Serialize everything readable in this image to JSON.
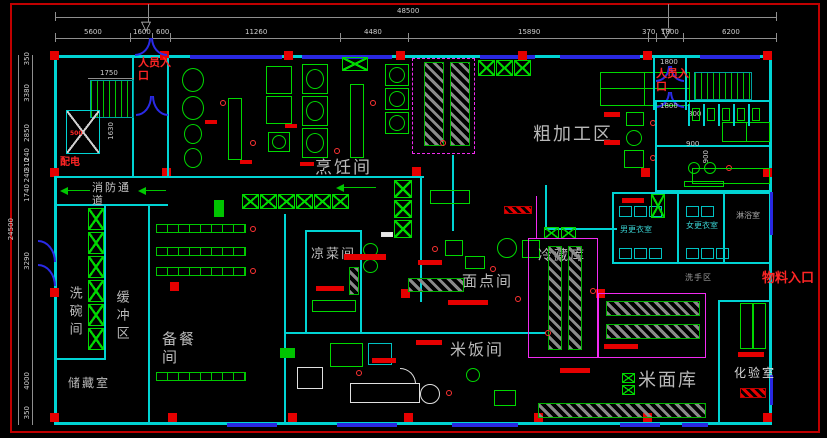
{
  "drawing": {
    "rooms": {
      "cooking": "烹饪间",
      "rough_processing": "粗加工区",
      "cold_dish": "凉菜间",
      "pastry": "面点间",
      "rice": "米饭间",
      "rice_flour_store": "米面库",
      "cold_storage": "冷藏库",
      "lab": "化验室",
      "dishwashing": "洗碗间",
      "buffer": "缓冲区",
      "food_prep": "备餐间",
      "storage": "储藏室",
      "fire_corridor": "消防通道",
      "men_changing": "男更衣室",
      "women_changing": "女更衣室",
      "shower": "淋浴室",
      "wash_area": "洗手区"
    },
    "entrances": {
      "personnel_left": "人员入口",
      "personnel_right": "人员入口",
      "material": "物料入口",
      "power": "配电"
    },
    "dims": {
      "top_total": "48500",
      "top": [
        "5600",
        "1600",
        "600",
        "11260",
        "4480",
        "15890",
        "370",
        "1800",
        "6200"
      ],
      "left_total": "24500",
      "left": [
        "350",
        "3380",
        "2850",
        "240",
        "310",
        "240",
        "1740",
        "3290",
        "4000",
        "350"
      ],
      "stair_width": "1750",
      "elevator_depth": "1630",
      "elevator_500": "500",
      "vest_top": "1800",
      "vest_mid": "1800",
      "toilet": "800",
      "corridor_w": "900",
      "corridor_h": "900"
    },
    "colors": {
      "wall": "#00d4d4",
      "window_door": "#2828e2",
      "equipment": "#00d800",
      "column": "#e60000",
      "shelf_border": "#f22bf2",
      "hatch_fill": "#8a8a8a",
      "dim_text": "#cdcdcd",
      "room_label": "#b9b9b9",
      "red_label": "#ff2525"
    }
  }
}
